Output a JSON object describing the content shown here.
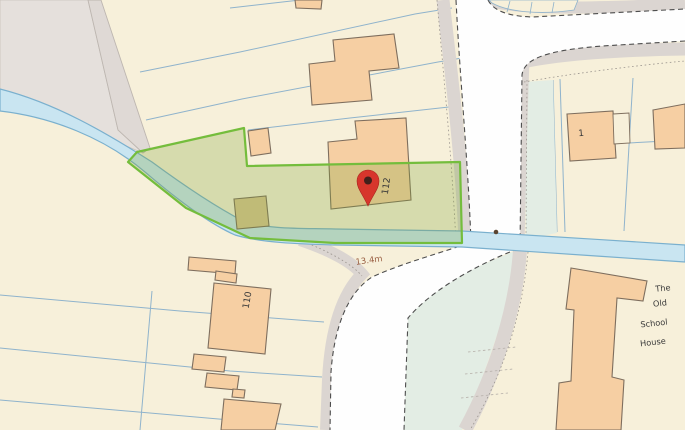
{
  "title": "Property location map",
  "colors": {
    "cream": "#F7F0DA",
    "gray-land": "#E5E0DC",
    "track": "#DFD9D5",
    "pavement": "#DBD5D1",
    "road": "#FEFEFE",
    "verge": "#E3EDE4",
    "water": "#C9E5F1",
    "water-edge": "#7AB0CE",
    "parcel-line": "#8FB3CC",
    "building": "#F6CFA3",
    "building-dark": "#D9C590",
    "building-edge": "#7E6E5E",
    "plot-stroke": "#74BD3C",
    "plot-fill": "rgba(124,164,52,0.27)",
    "casing": "#4D4D4D",
    "pin": "#D7362C",
    "pin-center": "#42201B",
    "label": "#3A3A3A",
    "label-brown": "#9A6044",
    "dot": "#5A4430"
  },
  "labels": {
    "plot_house_number": "112",
    "neighbour_house_number": "110",
    "corner_house_number": "1",
    "road_width": "13.4m",
    "old_school_house": [
      "The",
      "Old",
      "School",
      "House"
    ]
  }
}
